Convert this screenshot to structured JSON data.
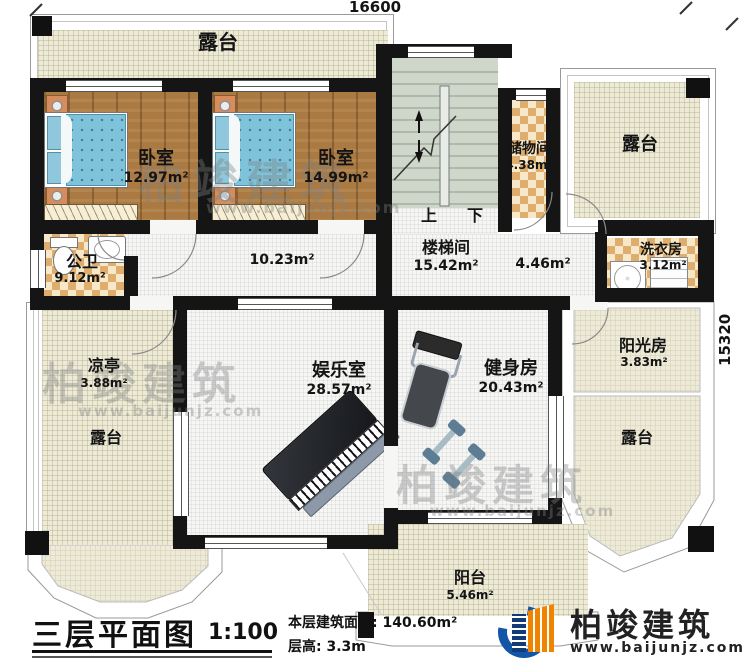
{
  "dimensions": {
    "width_label": "16600",
    "height_label": "15320"
  },
  "rooms": {
    "terrace_top": {
      "name": "露台"
    },
    "bedroom_1": {
      "name": "卧室",
      "area": "12.97m²"
    },
    "bedroom_2": {
      "name": "卧室",
      "area": "14.99m²"
    },
    "storage": {
      "name": "储物间",
      "area": "4.38m²"
    },
    "terrace_top_right": {
      "name": "露台"
    },
    "stairwell": {
      "name": "楼梯间",
      "area": "15.42m²",
      "up": "上",
      "down": "下"
    },
    "hallway": {
      "area": "10.23m²"
    },
    "hall_east": {
      "area": "4.46m²"
    },
    "laundry": {
      "name": "洗衣房",
      "area": "3.12m²"
    },
    "bathroom": {
      "name": "公卫",
      "area": "9.12m²"
    },
    "pavilion": {
      "name": "凉亭",
      "area": "3.88m²"
    },
    "terrace_left": {
      "name": "露台"
    },
    "entertainment": {
      "name": "娱乐室",
      "area": "28.57m²"
    },
    "gym": {
      "name": "健身房",
      "area": "20.43m²"
    },
    "sunroom": {
      "name": "阳光房",
      "area": "3.83m²"
    },
    "terrace_right": {
      "name": "露台"
    },
    "balcony": {
      "name": "阳台",
      "area": "5.46m²"
    }
  },
  "title_block": {
    "title": "三层平面图",
    "scale": "1:100",
    "floor_area_label": "本层建筑面积:",
    "floor_area_value": "140.60m²",
    "floor_height_label": "层高:",
    "floor_height_value": "3.3m"
  },
  "logo": {
    "company": "柏竣建筑",
    "website": "www.baijunjz.com"
  },
  "watermark": {
    "company": "柏竣建筑",
    "website": "www.baijunjz.com"
  },
  "colors": {
    "wall": "#151515",
    "terrace_fill": "#edead8",
    "wood_floor": "#aa7a42",
    "tile_accent": "#dfae6e",
    "stair_fill": "#cfd7cb",
    "bed": "#7ec3da",
    "logo_blue": "#1356a8",
    "logo_orange": "#f08300"
  }
}
